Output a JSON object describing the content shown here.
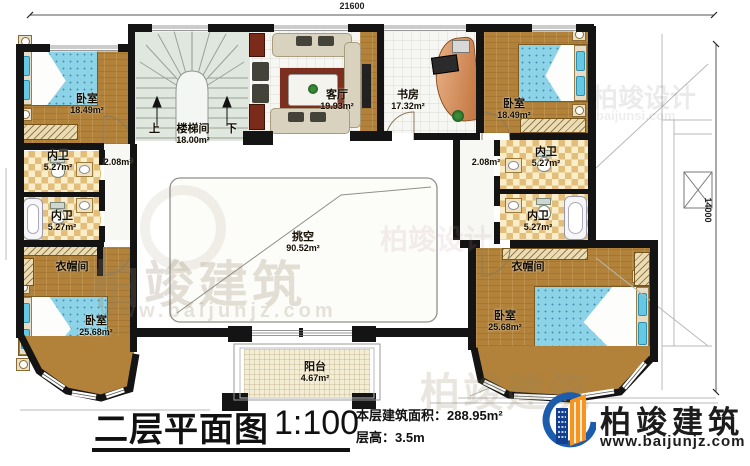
{
  "dimensions": {
    "top": "21600",
    "right": "14000"
  },
  "stairs": {
    "up": "上",
    "down": "下"
  },
  "rooms": [
    {
      "id": "bedroom-top-left",
      "label": "卧室",
      "area": "18.49m²"
    },
    {
      "id": "bath-left-1",
      "label": "内卫",
      "area": "5.27m²"
    },
    {
      "id": "bath-left-2",
      "label": "内卫",
      "area": "5.27m²"
    },
    {
      "id": "hall-left",
      "label": "",
      "area": "2.08m²"
    },
    {
      "id": "cloakroom-left",
      "label": "衣帽间",
      "area": ""
    },
    {
      "id": "bedroom-bottom-left",
      "label": "卧室",
      "area": "25.68m²"
    },
    {
      "id": "stairwell",
      "label": "楼梯间",
      "area": "18.00m²"
    },
    {
      "id": "living-room",
      "label": "客厅",
      "area": "19.93m²"
    },
    {
      "id": "study",
      "label": "书房",
      "area": "17.32m²"
    },
    {
      "id": "bedroom-top-right",
      "label": "卧室",
      "area": "18.49m²"
    },
    {
      "id": "bath-right-1",
      "label": "内卫",
      "area": "5.27m²"
    },
    {
      "id": "bath-right-2",
      "label": "内卫",
      "area": "5.27m²"
    },
    {
      "id": "hall-right",
      "label": "",
      "area": "2.08m²"
    },
    {
      "id": "cloakroom-right",
      "label": "衣帽间",
      "area": ""
    },
    {
      "id": "bedroom-bottom-right",
      "label": "卧室",
      "area": "25.68m²"
    },
    {
      "id": "void",
      "label": "挑空",
      "area": "90.52m²"
    },
    {
      "id": "balcony",
      "label": "阳台",
      "area": "4.67m²"
    }
  ],
  "title": {
    "name": "二层平面图",
    "scale": "1:100",
    "area_line": "本层建筑面积：288.95m²",
    "height_line": "层高：3.5m"
  },
  "brand": {
    "name": "柏竣建筑",
    "site": "www.baijunjz.com"
  },
  "watermarks": {
    "brand": "柏竣建筑",
    "brand_site": "www.baijunjz.com",
    "design": "柏竣设计",
    "design_site": "baijunsi.com"
  },
  "colors": {
    "wall": "#141414",
    "wood": "#b2823a",
    "accent_blue": "#1b5cad",
    "accent_orange": "#f7941e"
  }
}
